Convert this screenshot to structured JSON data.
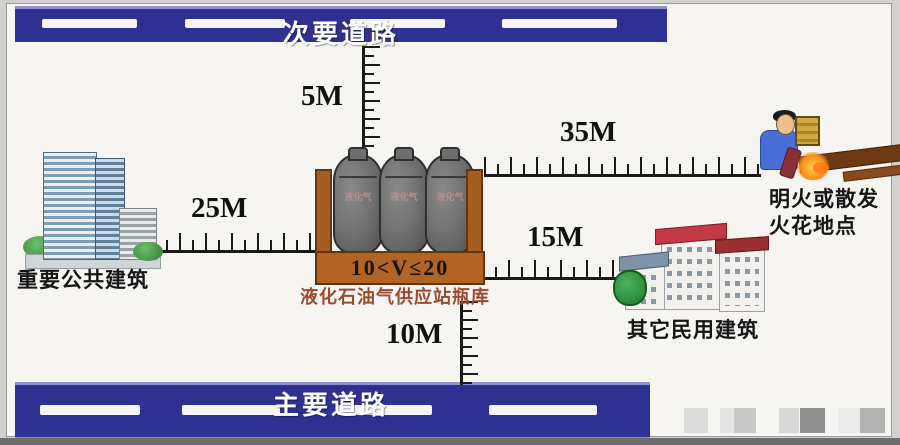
{
  "roads": {
    "secondary": {
      "label": "次要道路"
    },
    "main": {
      "label": "主要道路"
    }
  },
  "distances": {
    "to_secondary_road": "5M",
    "to_public_building": "25M",
    "to_flame_point": "35M",
    "to_civil_building": "15M",
    "to_main_road": "10M"
  },
  "station": {
    "volume_label": "10<V≤20",
    "caption": "液化石油气供应站瓶库",
    "tank_label": "液化气"
  },
  "buildings": {
    "public": {
      "label": "重要公共建筑"
    },
    "civil": {
      "label": "其它民用建筑"
    }
  },
  "hazard": {
    "line1": "明火或散发",
    "line2": "火花地点"
  },
  "colors": {
    "road_blue": "#2e3192",
    "container_brown": "#b26425",
    "caption_brown": "#9c4a2e",
    "ruler_black": "#1a1a1a"
  }
}
